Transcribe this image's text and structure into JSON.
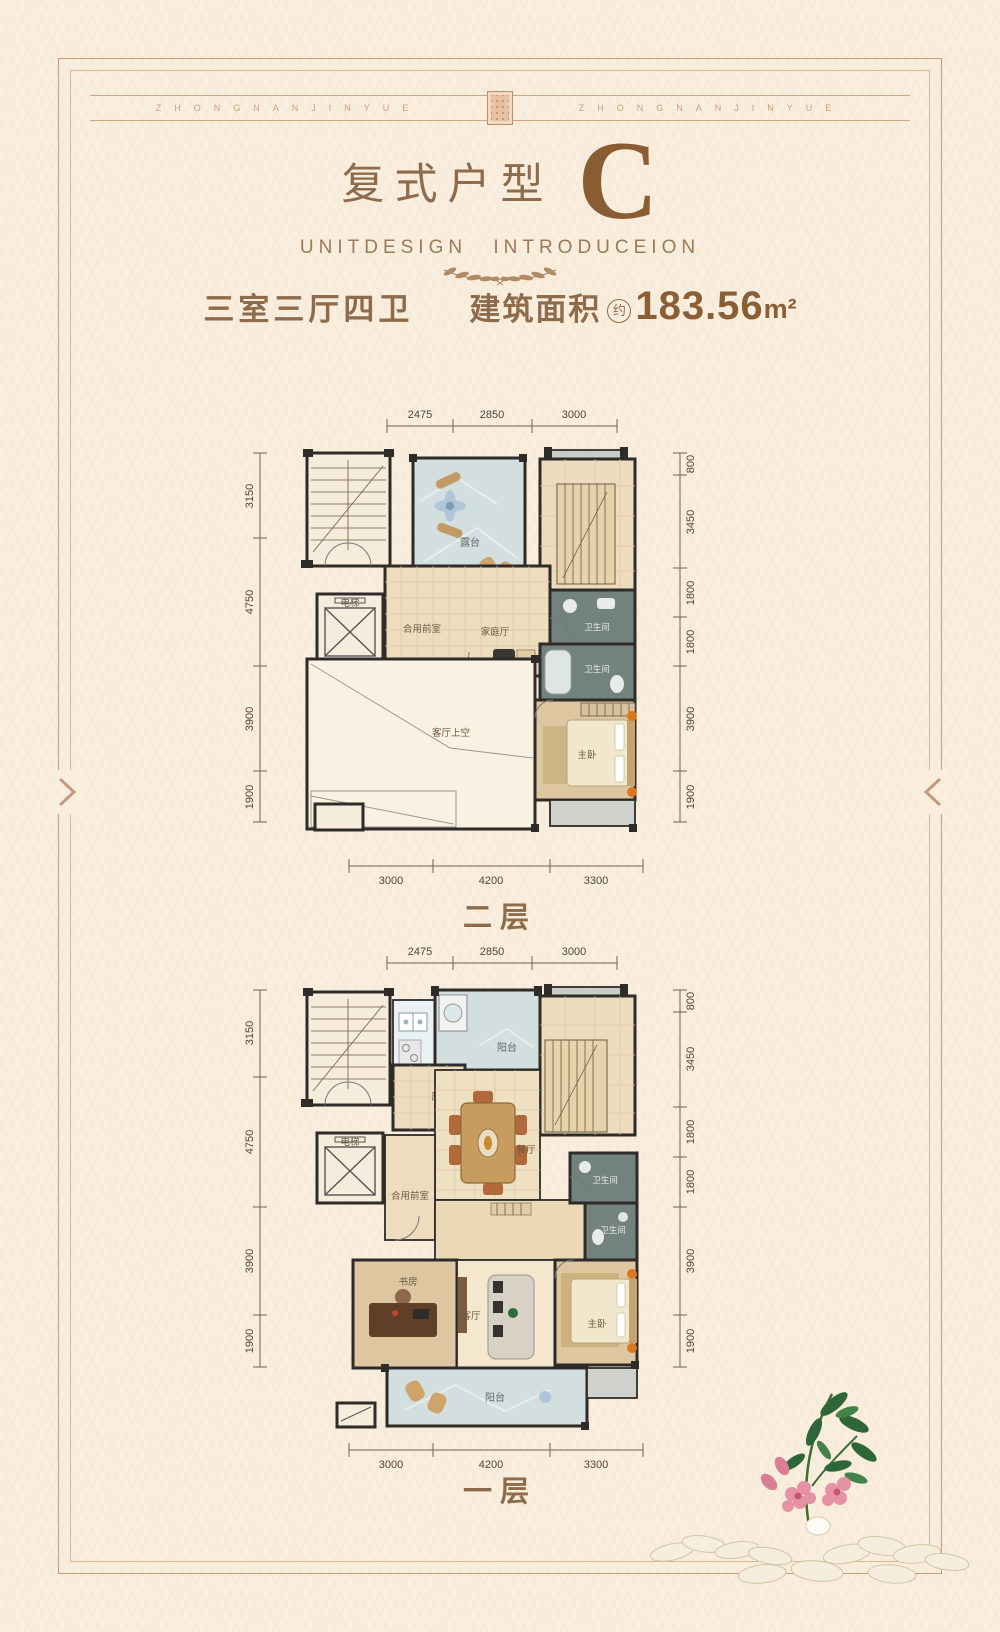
{
  "page": {
    "band_text_left": "ZHONGNANJINYUE",
    "band_text_right": "ZHONGNANJINYUE"
  },
  "header": {
    "title_cn": "复式户型",
    "title_letter": "C",
    "subtitle": "UNITDESIGN INTRODUCEION",
    "spec_rooms": "三室三厅四卫",
    "area_label": "建筑面积",
    "area_approx": "约",
    "area_value": "183.56",
    "area_unit": "m²"
  },
  "icons": {
    "left_edge": "chevron-right-icon",
    "right_edge": "chevron-left-icon",
    "ornament": "laurel-branches-icon"
  },
  "colors": {
    "accent_brown": "#8a5c32",
    "text_brown": "#8d6b4b",
    "frame": "#c59a7d",
    "wall": "#2e2b28",
    "tile_tan": "#eddcbe",
    "tile_marble": "#d3dfde",
    "tile_bath": "#73827d"
  },
  "plans": [
    {
      "label": "二层",
      "dims_top": [
        "2475",
        "2850",
        "3000"
      ],
      "dims_bottom": [
        "3000",
        "4200",
        "3300"
      ],
      "dims_left": [
        "3150",
        "4750",
        "3900",
        "1900"
      ],
      "dims_right": [
        "800",
        "3450",
        "1800",
        "1800",
        "3900",
        "1900"
      ],
      "rooms": {
        "terrace": "露台",
        "elevator": "电梯",
        "foyer": "合用前室",
        "family_hall": "家庭厅",
        "bath_1": "卫生间",
        "bath_2": "卫生间",
        "living_void": "客厅上空",
        "master": "主卧"
      }
    },
    {
      "label": "一层",
      "dims_top": [
        "2475",
        "2850",
        "3000"
      ],
      "dims_bottom": [
        "3000",
        "4200",
        "3300"
      ],
      "dims_left": [
        "3150",
        "4750",
        "3900",
        "1900"
      ],
      "dims_right": [
        "800",
        "3450",
        "1800",
        "1800",
        "3900",
        "1900"
      ],
      "rooms": {
        "balcony_top": "阳台",
        "kitchen": "厨房",
        "dining": "餐厅",
        "elevator": "电梯",
        "foyer": "合用前室",
        "bath_1": "卫生间",
        "bath_2": "卫生间",
        "study": "书房",
        "living": "客厅",
        "master": "主卧",
        "balcony_bottom": "阳台"
      }
    }
  ]
}
